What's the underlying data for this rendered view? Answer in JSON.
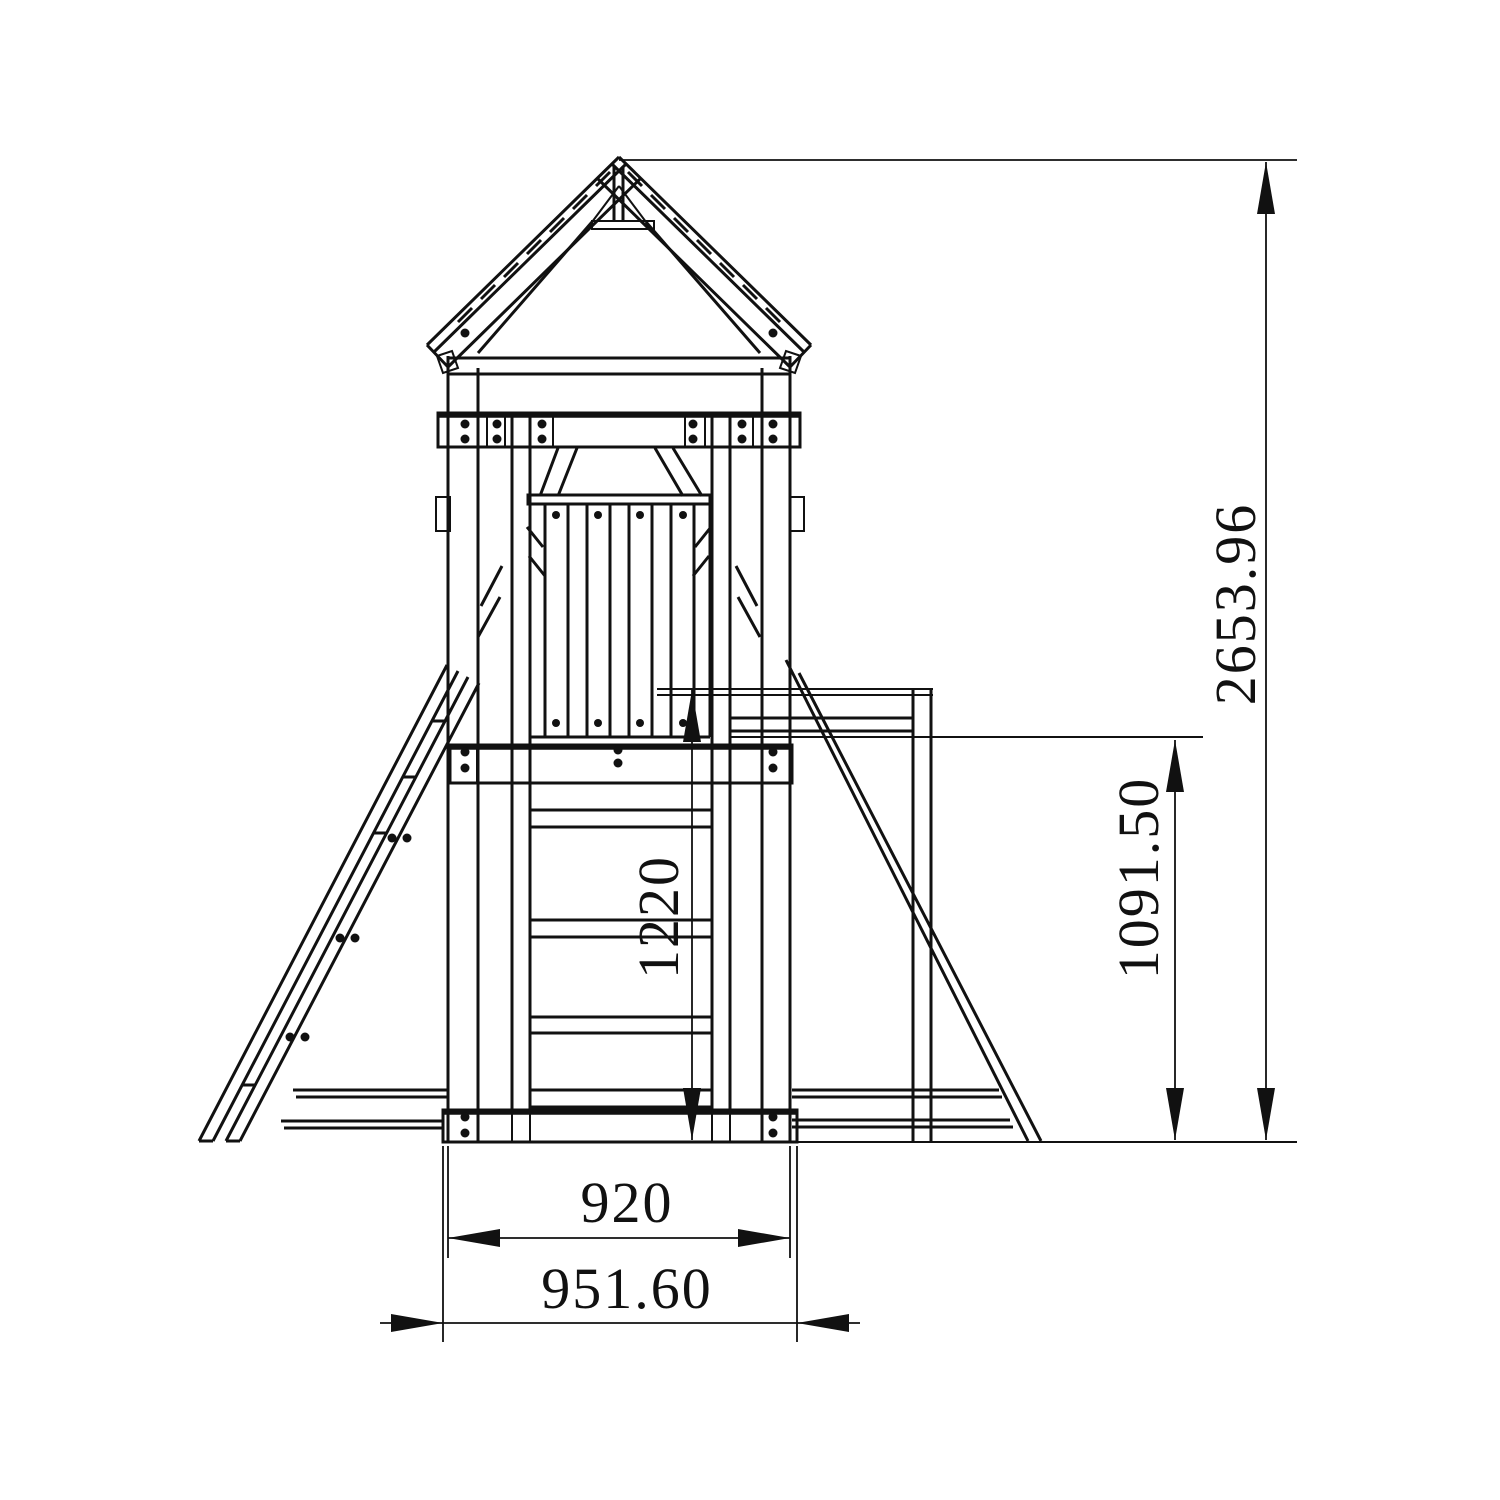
{
  "drawing": {
    "dimensions": {
      "overall_height": "2653.96",
      "beam_height": "1091.50",
      "platform_height": "1220",
      "frame_width": "920",
      "base_width": "951.60"
    },
    "colors": {
      "line": "#111111",
      "background": "#ffffff"
    }
  }
}
